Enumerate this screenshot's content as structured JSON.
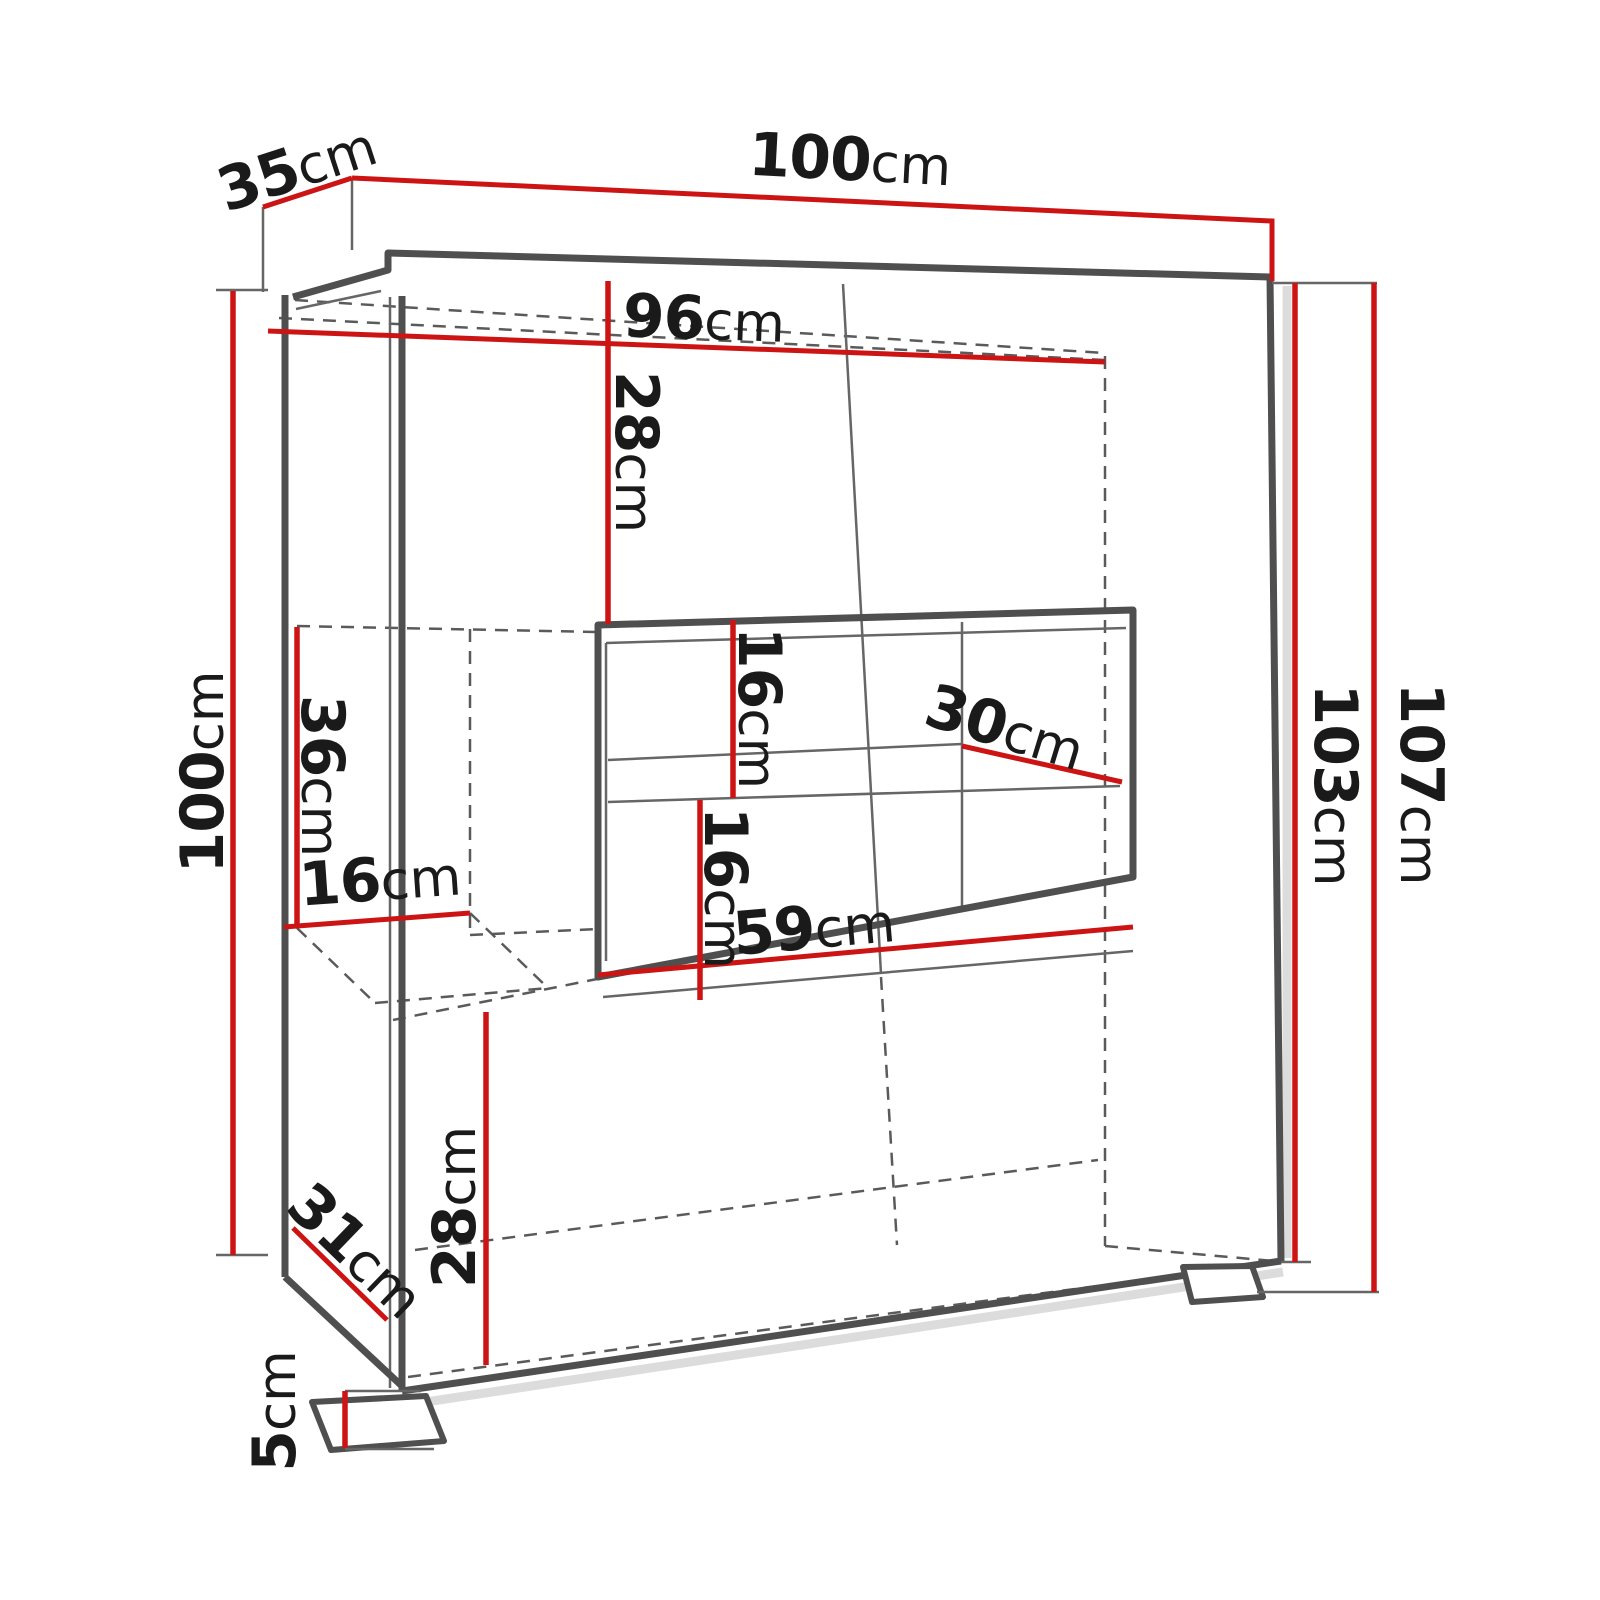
{
  "diagram": {
    "type": "furniture-dimension-drawing",
    "subject": "display cabinet / sideboard perspective line drawing with dimension callouts",
    "unit": "cm"
  },
  "labels": {
    "width_top": {
      "num": "100",
      "unit": "cm"
    },
    "depth_top": {
      "num": "35",
      "unit": "cm"
    },
    "inner_width": {
      "num": "96",
      "unit": "cm"
    },
    "upper_section_height": {
      "num": "28",
      "unit": "cm"
    },
    "left_height": {
      "num": "100",
      "unit": "cm"
    },
    "side_compartment_height": {
      "num": "36",
      "unit": "cm"
    },
    "side_compartment_width": {
      "num": "16",
      "unit": "cm"
    },
    "niche_upper_gap": {
      "num": "16",
      "unit": "cm"
    },
    "niche_depth": {
      "num": "30",
      "unit": "cm"
    },
    "niche_lower_gap": {
      "num": "16",
      "unit": "cm"
    },
    "niche_width": {
      "num": "59",
      "unit": "cm"
    },
    "body_height": {
      "num": "103",
      "unit": "cm"
    },
    "total_height": {
      "num": "107",
      "unit": "cm"
    },
    "base_depth": {
      "num": "31",
      "unit": "cm"
    },
    "lower_section_height": {
      "num": "28",
      "unit": "cm"
    },
    "foot_height": {
      "num": "5",
      "unit": "cm"
    }
  },
  "colors": {
    "dimension_red": "#cd1414",
    "line_gray": "#4f4f4f",
    "thin_gray": "#666666",
    "dash_gray": "#5a5a5a",
    "text_ink": "#1a1a1a",
    "shadow_gray": "#dcdcdc",
    "background": "#ffffff"
  }
}
